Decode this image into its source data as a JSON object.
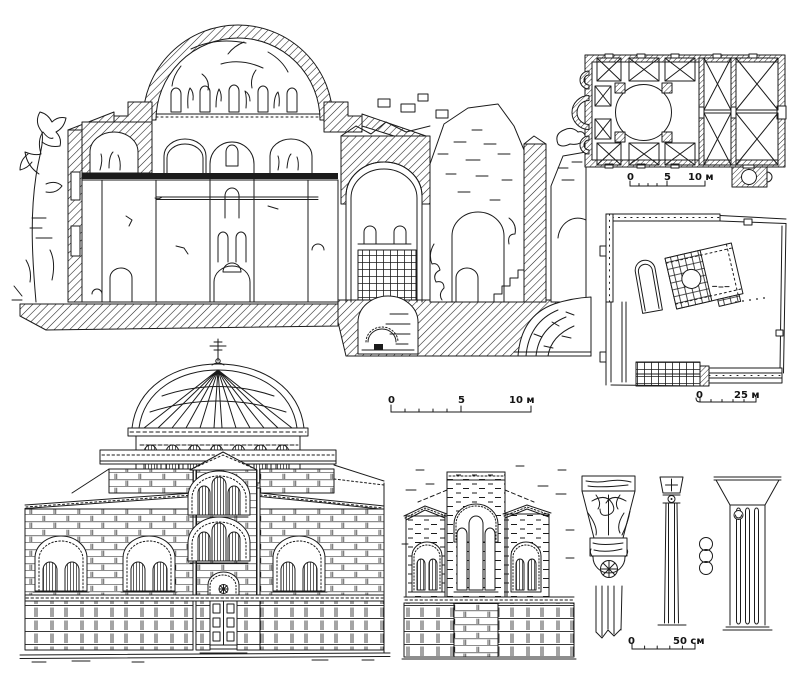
{
  "figure": {
    "paper_color": "#ffffff",
    "ink_color": "#1b1b1b",
    "panels": {
      "section": "church-cross-section-with-dome-mosaics",
      "floor_plan": "church-floor-plan",
      "site_plan": "monastery-site-plan",
      "elevation": "church-facade-elevation",
      "fragment": "facade-fragment-elevation",
      "details": "capital-and-column-details"
    }
  },
  "scales": {
    "floor_plan_scale": {
      "labels": [
        "0",
        "5",
        "10 м"
      ]
    },
    "section_scale": {
      "labels": [
        "0",
        "5",
        "10 м"
      ]
    },
    "site_plan_scale": {
      "labels": [
        "0",
        "25 м"
      ]
    },
    "details_scale": {
      "labels": [
        "0",
        "50 см"
      ]
    }
  }
}
